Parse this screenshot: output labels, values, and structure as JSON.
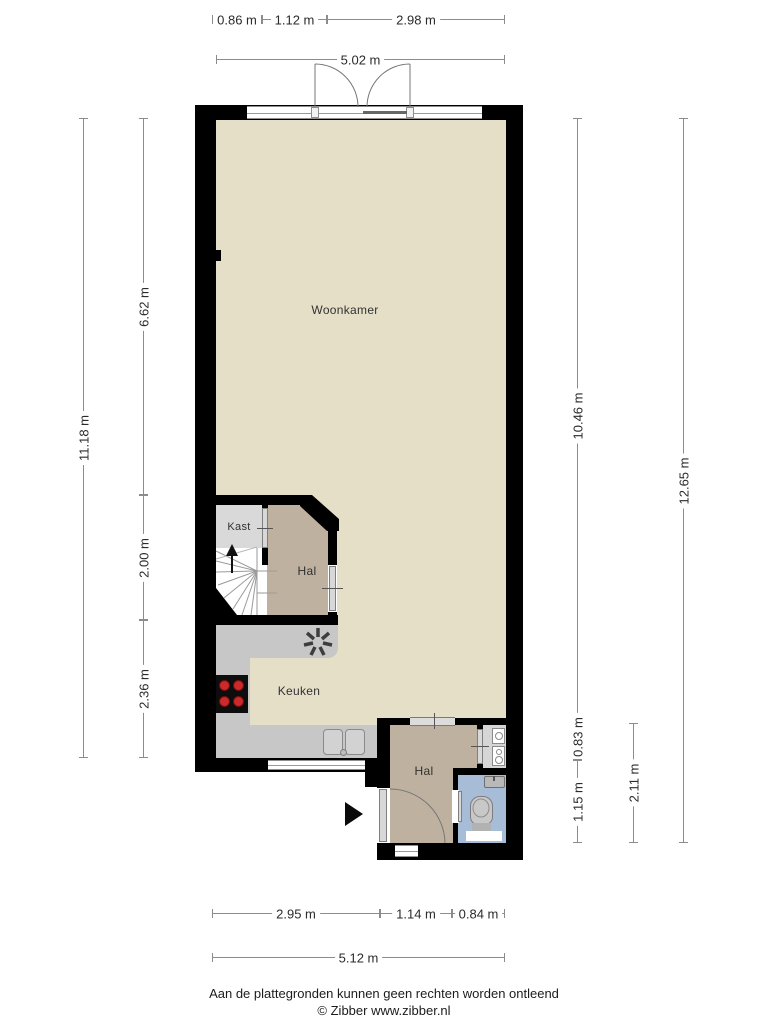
{
  "rooms": {
    "woonkamer": "Woonkamer",
    "kast": "Kast",
    "hal_boven": "Hal",
    "keuken": "Keuken",
    "hal_beneden": "Hal"
  },
  "dimensions": {
    "top_row1": [
      "0.86 m",
      "1.12 m",
      "2.98 m"
    ],
    "top_row2": "5.02 m",
    "left_outer": "11.18 m",
    "left_inner": [
      "6.62 m",
      "2.00 m",
      "2.36 m"
    ],
    "right_inner": [
      "10.46 m",
      "0.83 m",
      "1.15 m"
    ],
    "right_outer": "12.65 m",
    "right_mid": "2.11 m",
    "bottom_row1": [
      "2.95 m",
      "1.14 m",
      "0.84 m"
    ],
    "bottom_row2": "5.12 m"
  },
  "footer": {
    "disclaimer": "Aan de plattegronden kunnen geen rechten worden ontleend",
    "credit": "© Zibber www.zibber.nl"
  },
  "colors": {
    "floor_main": "#e6dfc8",
    "floor_hal": "#bfb1a0",
    "floor_kast": "#d9d9d9",
    "floor_wc": "#a7bcd7",
    "counter": "#c7c7c7",
    "wall": "#000000",
    "burner": "#cc2a2a",
    "dim_line": "#8c8c8c"
  }
}
